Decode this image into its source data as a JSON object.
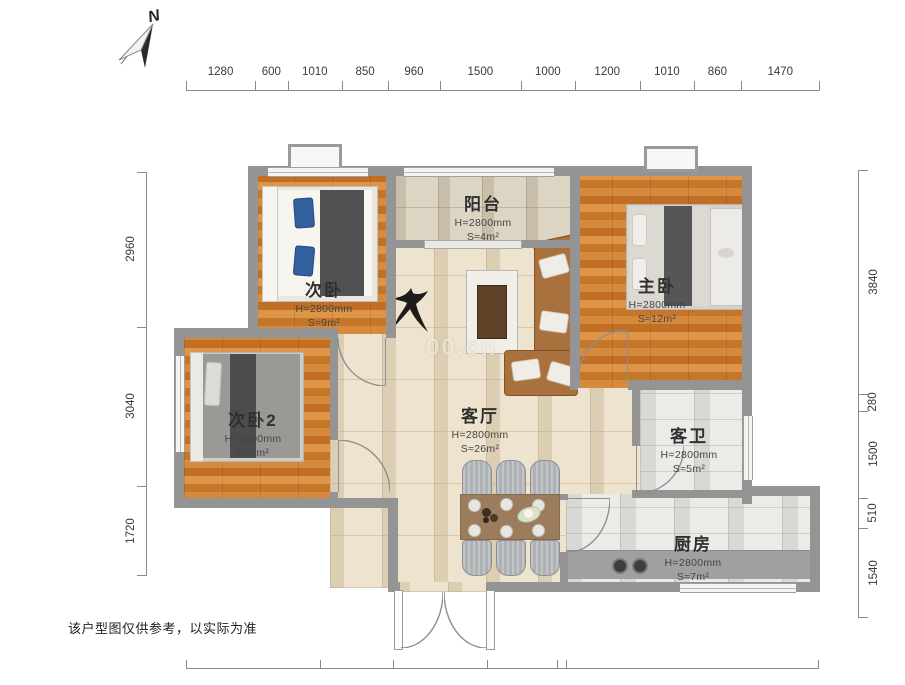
{
  "compass": {
    "label": "N"
  },
  "watermark": "00.cn",
  "disclaimer": "该户型图仅供参考，以实际为准",
  "dimensions": {
    "top": [
      "1280",
      "600",
      "1010",
      "850",
      "960",
      "1500",
      "1000",
      "1200",
      "1010",
      "860",
      "1470"
    ],
    "left": [
      "2960",
      "3040",
      "1720"
    ],
    "right": [
      "3840",
      "280",
      "1500",
      "510",
      "1540"
    ]
  },
  "rooms": [
    {
      "name": "次卧",
      "ceiling": "H=2800mm",
      "area": "S≈9m²"
    },
    {
      "name": "阳台",
      "ceiling": "H=2800mm",
      "area": "S≈4m²"
    },
    {
      "name": "主卧",
      "ceiling": "H=2800mm",
      "area": "S≈12m²"
    },
    {
      "name": "次卧2",
      "ceiling": "H=2800mm",
      "area": "S≈8m²"
    },
    {
      "name": "客厅",
      "ceiling": "H=2800mm",
      "area": "S≈26m²"
    },
    {
      "name": "客卫",
      "ceiling": "H=2800mm",
      "area": "S≈5m²"
    },
    {
      "name": "厨房",
      "ceiling": "H=2800mm",
      "area": "S≈7m²"
    }
  ],
  "colors": {
    "wall": "#949494",
    "wood": "#cf8138",
    "tile": "#ede3cf",
    "sofa": "#a9713d",
    "pillow_accent": "#33609c"
  }
}
